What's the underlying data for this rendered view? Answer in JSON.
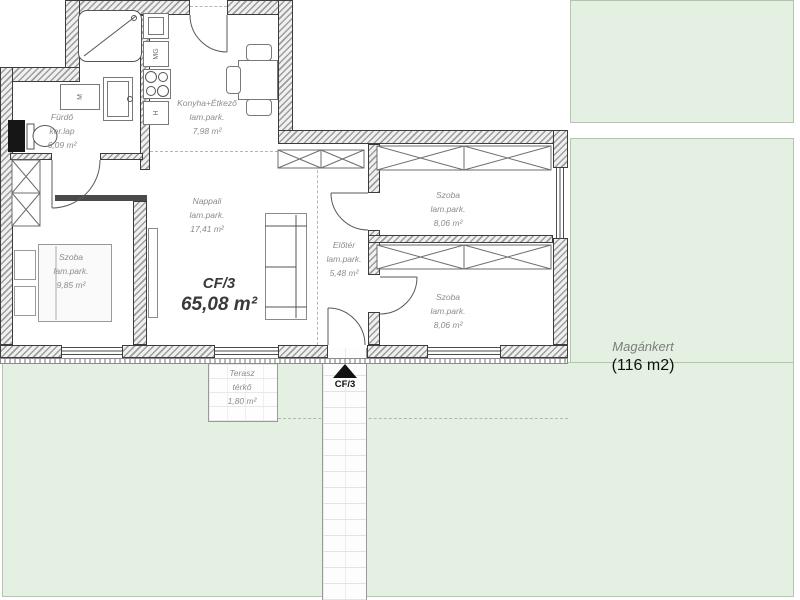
{
  "unit": {
    "code": "CF/3",
    "area": "65,08 m²"
  },
  "entrance": {
    "label": "CF/3"
  },
  "garden": {
    "name": "Magánkert",
    "area": "(116 m2)"
  },
  "rooms": {
    "bathroom": {
      "name": "Fürdő",
      "finish": "ker.lap",
      "area": "6,09 m²"
    },
    "kitchen": {
      "name": "Konyha+Étkező",
      "finish": "lam.park.",
      "area": "7,98 m²"
    },
    "living": {
      "name": "Nappali",
      "finish": "lam.park.",
      "area": "17,41 m²"
    },
    "bedroom1": {
      "name": "Szoba",
      "finish": "lam.park.",
      "area": "9,85 m²"
    },
    "hall": {
      "name": "Előtér",
      "finish": "lam.park.",
      "area": "5,48 m²"
    },
    "bedroom2": {
      "name": "Szoba",
      "finish": "lam.park.",
      "area": "8,06 m²"
    },
    "bedroom3": {
      "name": "Szoba",
      "finish": "lam.park.",
      "area": "8,06 m²"
    },
    "terrace": {
      "name": "Terasz",
      "finish": "térkő",
      "area": "1,80 m²"
    }
  },
  "appliances": {
    "washing_machine": "M",
    "dishwasher": "MG",
    "fridge": "H"
  },
  "colors": {
    "garden_green": "#e4f0e2",
    "wall_stroke": "#3c3c3c",
    "label_gray": "#8c8c8c"
  }
}
